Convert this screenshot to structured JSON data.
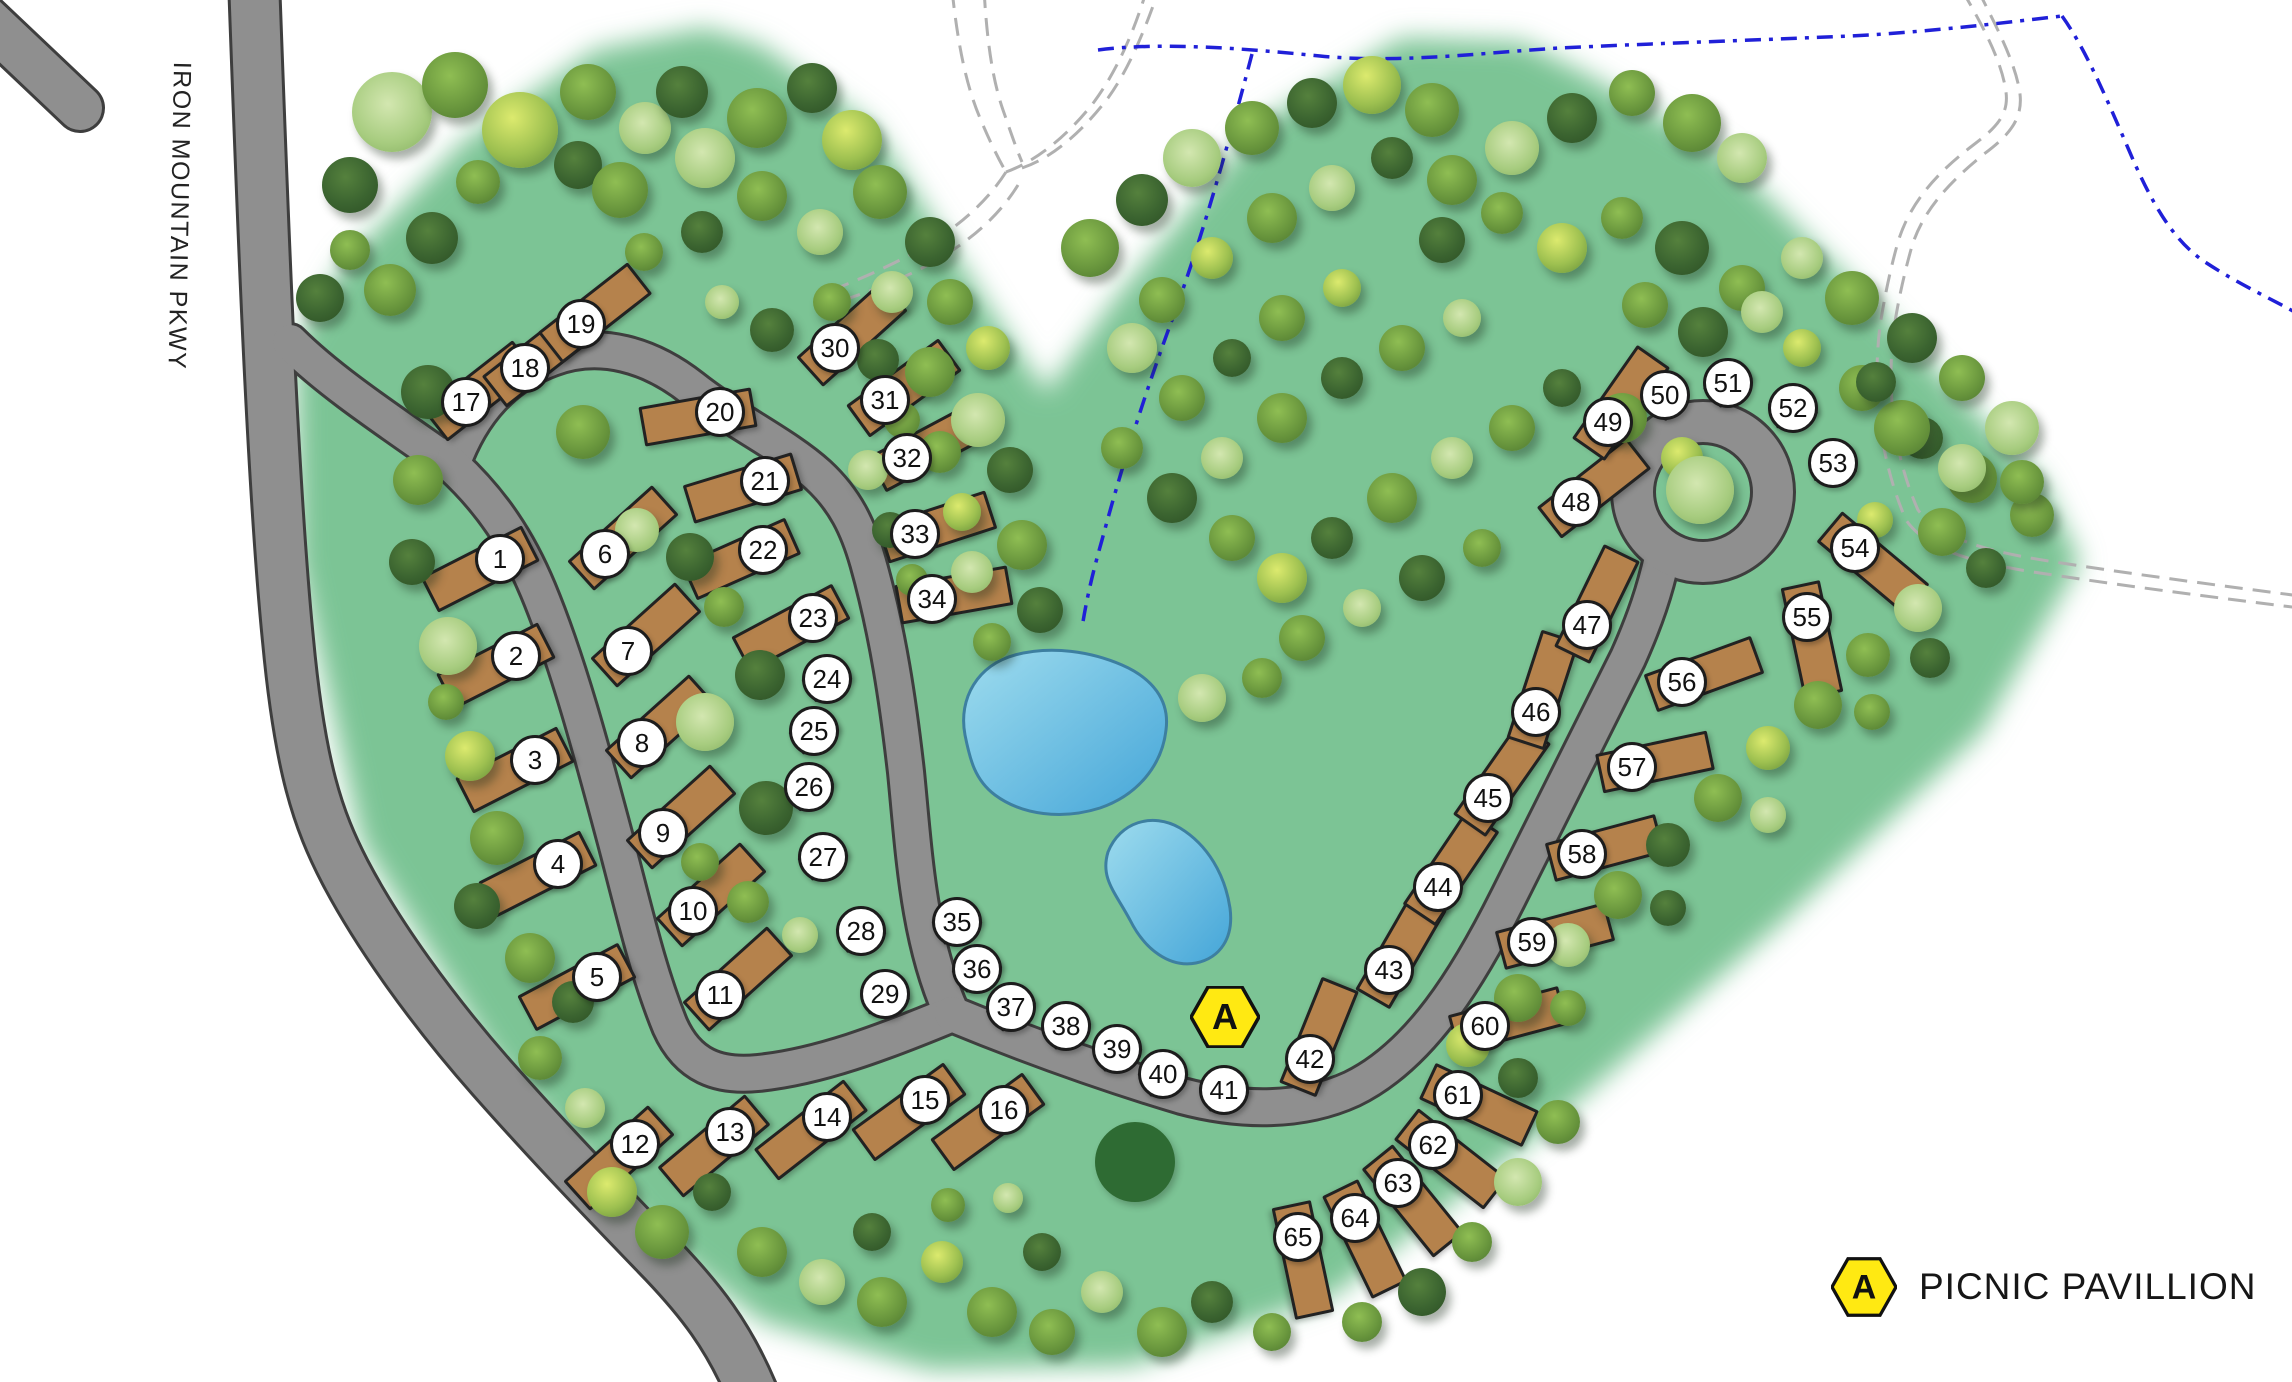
{
  "road_label": "IRON MOUNTAIN PKWY",
  "legend": {
    "marker_letter": "A",
    "label": "PICNIC PAVILLION"
  },
  "pavilion_marker": {
    "letter": "A",
    "x": 1225,
    "y": 1017
  },
  "site_dims": {
    "rv": [
      114,
      40
    ],
    "tent": [
      44,
      27
    ]
  },
  "sites_format": [
    "number",
    "x",
    "y",
    "rotation_deg",
    "type",
    "pad_offset_x",
    "pad_offset_y"
  ],
  "sites": [
    [
      1,
      500,
      559,
      -27,
      "rv",
      -20,
      10
    ],
    [
      2,
      516,
      656,
      -27,
      "rv",
      -20,
      10
    ],
    [
      3,
      535,
      760,
      -27,
      "rv",
      -20,
      10
    ],
    [
      4,
      558,
      864,
      -27,
      "rv",
      -20,
      10
    ],
    [
      5,
      597,
      977,
      -28,
      "rv",
      -20,
      10
    ],
    [
      6,
      605,
      554,
      -42,
      "rv",
      18,
      -16
    ],
    [
      7,
      628,
      651,
      -42,
      "rv",
      18,
      -16
    ],
    [
      8,
      642,
      743,
      -42,
      "rv",
      18,
      -16
    ],
    [
      9,
      663,
      833,
      -42,
      "rv",
      18,
      -16
    ],
    [
      10,
      693,
      911,
      -42,
      "rv",
      18,
      -16
    ],
    [
      11,
      720,
      995,
      -42,
      "rv",
      18,
      -16
    ],
    [
      12,
      635,
      1144,
      -42,
      "rv",
      -16,
      14
    ],
    [
      13,
      730,
      1132,
      -40,
      "rv",
      -16,
      14
    ],
    [
      14,
      827,
      1117,
      -38,
      "rv",
      -16,
      13
    ],
    [
      15,
      925,
      1100,
      -36,
      "rv",
      -16,
      12
    ],
    [
      16,
      1004,
      1110,
      -36,
      "rv",
      -16,
      12
    ],
    [
      17,
      466,
      402,
      -38,
      "rv",
      14,
      -11
    ],
    [
      18,
      525,
      368,
      -38,
      "rv",
      14,
      -11
    ],
    [
      19,
      581,
      324,
      -38,
      "rv",
      14,
      -11
    ],
    [
      20,
      720,
      412,
      -10,
      "rv",
      -22,
      5
    ],
    [
      21,
      765,
      481,
      -17,
      "rv",
      -22,
      7
    ],
    [
      22,
      763,
      550,
      -24,
      "rv",
      -22,
      9
    ],
    [
      23,
      813,
      618,
      -28,
      "rv",
      -22,
      10
    ],
    [
      24,
      827,
      679,
      -32,
      "tent",
      0,
      0
    ],
    [
      25,
      814,
      731,
      -34,
      "tent",
      0,
      0
    ],
    [
      26,
      809,
      787,
      -38,
      "tent",
      0,
      0
    ],
    [
      27,
      823,
      857,
      -34,
      "tent",
      0,
      0
    ],
    [
      28,
      861,
      931,
      -26,
      "tent",
      0,
      0
    ],
    [
      29,
      885,
      994,
      -20,
      "tent",
      0,
      0
    ],
    [
      30,
      835,
      348,
      -42,
      "rv",
      17,
      -14
    ],
    [
      31,
      885,
      400,
      -36,
      "rv",
      19,
      -12
    ],
    [
      32,
      907,
      458,
      -28,
      "rv",
      20,
      -10
    ],
    [
      33,
      915,
      534,
      -18,
      "rv",
      22,
      -7
    ],
    [
      34,
      932,
      599,
      -10,
      "rv",
      22,
      -4
    ],
    [
      35,
      957,
      922,
      -30,
      "tent",
      0,
      0
    ],
    [
      36,
      977,
      969,
      -35,
      "tent",
      0,
      0
    ],
    [
      37,
      1011,
      1007,
      -40,
      "tent",
      0,
      0
    ],
    [
      38,
      1066,
      1026,
      -35,
      "tent",
      0,
      0
    ],
    [
      39,
      1117,
      1049,
      -30,
      "tent",
      0,
      0
    ],
    [
      40,
      1163,
      1074,
      -30,
      "tent",
      0,
      0
    ],
    [
      41,
      1224,
      1090,
      -25,
      "tent",
      0,
      0
    ],
    [
      42,
      1310,
      1059,
      -68,
      "rv",
      9,
      -22
    ],
    [
      43,
      1389,
      970,
      -60,
      "rv",
      12,
      -20
    ],
    [
      44,
      1438,
      887,
      -56,
      "rv",
      13,
      -19
    ],
    [
      45,
      1488,
      798,
      -55,
      "rv",
      14,
      -19
    ],
    [
      46,
      1536,
      712,
      -72,
      "rv",
      7,
      -22
    ],
    [
      47,
      1587,
      625,
      -64,
      "rv",
      10,
      -21
    ],
    [
      48,
      1576,
      502,
      -38,
      "rv",
      18,
      -14
    ],
    [
      49,
      1608,
      422,
      -55,
      "rv",
      13,
      -19
    ],
    [
      50,
      1665,
      395,
      -62,
      "tent",
      0,
      0
    ],
    [
      51,
      1728,
      383,
      -42,
      "tent",
      0,
      0
    ],
    [
      52,
      1793,
      408,
      -20,
      "tent",
      0,
      0
    ],
    [
      53,
      1833,
      463,
      -12,
      "tent",
      0,
      0
    ],
    [
      54,
      1855,
      548,
      40,
      "rv",
      18,
      15
    ],
    [
      55,
      1807,
      617,
      78,
      "rv",
      5,
      23
    ],
    [
      56,
      1682,
      682,
      -20,
      "rv",
      22,
      -8
    ],
    [
      57,
      1632,
      767,
      -12,
      "rv",
      23,
      -5
    ],
    [
      58,
      1582,
      854,
      -15,
      "rv",
      23,
      -6
    ],
    [
      59,
      1532,
      942,
      -15,
      "rv",
      23,
      -6
    ],
    [
      60,
      1485,
      1026,
      -15,
      "rv",
      23,
      -6
    ],
    [
      61,
      1458,
      1095,
      25,
      "rv",
      21,
      10
    ],
    [
      62,
      1433,
      1145,
      38,
      "rv",
      18,
      14
    ],
    [
      63,
      1398,
      1183,
      51,
      "rv",
      15,
      18
    ],
    [
      64,
      1355,
      1218,
      64,
      "rv",
      10,
      21
    ],
    [
      65,
      1298,
      1237,
      78,
      "rv",
      5,
      23
    ]
  ],
  "trees_format": [
    "x",
    "y",
    "radius",
    "shade_variant"
  ],
  "trees": [
    [
      392,
      112,
      40,
      2
    ],
    [
      350,
      185,
      28,
      0
    ],
    [
      455,
      85,
      33,
      1
    ],
    [
      520,
      130,
      38,
      3
    ],
    [
      588,
      92,
      28,
      1
    ],
    [
      645,
      128,
      26,
      2
    ],
    [
      578,
      165,
      24,
      0
    ],
    [
      478,
      182,
      22,
      1
    ],
    [
      432,
      238,
      26,
      0
    ],
    [
      390,
      290,
      26,
      1
    ],
    [
      620,
      190,
      28,
      1
    ],
    [
      682,
      92,
      26,
      0
    ],
    [
      705,
      158,
      30,
      2
    ],
    [
      757,
      118,
      30,
      1
    ],
    [
      812,
      88,
      25,
      0
    ],
    [
      852,
      140,
      30,
      3
    ],
    [
      762,
      196,
      25,
      1
    ],
    [
      820,
      232,
      23,
      2
    ],
    [
      702,
      232,
      21,
      0
    ],
    [
      644,
      252,
      19,
      1
    ],
    [
      880,
      192,
      27,
      1
    ],
    [
      930,
      242,
      25,
      0
    ],
    [
      892,
      292,
      21,
      2
    ],
    [
      950,
      302,
      23,
      1
    ],
    [
      988,
      348,
      22,
      3
    ],
    [
      832,
      302,
      19,
      1
    ],
    [
      772,
      330,
      22,
      0
    ],
    [
      722,
      302,
      17,
      2
    ],
    [
      320,
      298,
      24,
      0
    ],
    [
      350,
      250,
      20,
      1
    ],
    [
      428,
      392,
      27,
      0
    ],
    [
      418,
      480,
      25,
      1
    ],
    [
      412,
      562,
      23,
      0
    ],
    [
      448,
      646,
      29,
      2
    ],
    [
      446,
      702,
      18,
      1
    ],
    [
      470,
      756,
      25,
      3
    ],
    [
      497,
      838,
      27,
      1
    ],
    [
      477,
      906,
      23,
      0
    ],
    [
      530,
      958,
      25,
      1
    ],
    [
      573,
      1002,
      21,
      0
    ],
    [
      540,
      1058,
      22,
      1
    ],
    [
      585,
      1108,
      20,
      2
    ],
    [
      583,
      432,
      27,
      1
    ],
    [
      637,
      530,
      22,
      2
    ],
    [
      690,
      557,
      24,
      0
    ],
    [
      724,
      607,
      20,
      1
    ],
    [
      760,
      675,
      25,
      0
    ],
    [
      705,
      722,
      29,
      2
    ],
    [
      766,
      808,
      27,
      0
    ],
    [
      700,
      862,
      19,
      1
    ],
    [
      748,
      902,
      21,
      1
    ],
    [
      800,
      935,
      18,
      2
    ],
    [
      878,
      360,
      21,
      0
    ],
    [
      930,
      372,
      25,
      1
    ],
    [
      978,
      420,
      27,
      2
    ],
    [
      940,
      452,
      21,
      1
    ],
    [
      1010,
      470,
      23,
      0
    ],
    [
      962,
      512,
      19,
      3
    ],
    [
      1022,
      545,
      25,
      1
    ],
    [
      972,
      572,
      21,
      2
    ],
    [
      1040,
      610,
      23,
      0
    ],
    [
      992,
      642,
      19,
      1
    ],
    [
      902,
      420,
      18,
      1
    ],
    [
      868,
      470,
      20,
      2
    ],
    [
      890,
      530,
      18,
      0
    ],
    [
      912,
      580,
      16,
      1
    ],
    [
      1090,
      248,
      29,
      1
    ],
    [
      1142,
      200,
      26,
      0
    ],
    [
      1192,
      158,
      29,
      2
    ],
    [
      1252,
      128,
      27,
      1
    ],
    [
      1312,
      103,
      25,
      0
    ],
    [
      1372,
      85,
      29,
      3
    ],
    [
      1432,
      110,
      27,
      1
    ],
    [
      1162,
      300,
      23,
      1
    ],
    [
      1212,
      258,
      21,
      3
    ],
    [
      1272,
      218,
      25,
      1
    ],
    [
      1332,
      188,
      23,
      2
    ],
    [
      1392,
      158,
      21,
      0
    ],
    [
      1452,
      180,
      25,
      1
    ],
    [
      1512,
      148,
      27,
      2
    ],
    [
      1572,
      118,
      25,
      0
    ],
    [
      1632,
      93,
      23,
      1
    ],
    [
      1692,
      123,
      29,
      1
    ],
    [
      1742,
      158,
      25,
      2
    ],
    [
      1442,
      240,
      23,
      0
    ],
    [
      1502,
      213,
      21,
      1
    ],
    [
      1562,
      248,
      25,
      3
    ],
    [
      1622,
      218,
      21,
      1
    ],
    [
      1682,
      248,
      27,
      0
    ],
    [
      1742,
      288,
      23,
      1
    ],
    [
      1802,
      258,
      21,
      2
    ],
    [
      1852,
      298,
      27,
      1
    ],
    [
      1912,
      338,
      25,
      0
    ],
    [
      1962,
      378,
      23,
      1
    ],
    [
      2012,
      428,
      27,
      2
    ],
    [
      1802,
      348,
      19,
      3
    ],
    [
      1862,
      388,
      23,
      1
    ],
    [
      1922,
      438,
      21,
      0
    ],
    [
      1972,
      478,
      25,
      1
    ],
    [
      2032,
      515,
      22,
      1
    ],
    [
      1132,
      348,
      25,
      2
    ],
    [
      1182,
      398,
      23,
      1
    ],
    [
      1232,
      358,
      19,
      0
    ],
    [
      1282,
      318,
      23,
      1
    ],
    [
      1342,
      288,
      19,
      3
    ],
    [
      1122,
      448,
      21,
      1
    ],
    [
      1172,
      498,
      25,
      0
    ],
    [
      1222,
      458,
      21,
      2
    ],
    [
      1282,
      418,
      25,
      1
    ],
    [
      1342,
      378,
      21,
      0
    ],
    [
      1402,
      348,
      23,
      1
    ],
    [
      1462,
      318,
      19,
      2
    ],
    [
      1232,
      538,
      23,
      1
    ],
    [
      1282,
      578,
      25,
      3
    ],
    [
      1332,
      538,
      21,
      0
    ],
    [
      1392,
      498,
      25,
      1
    ],
    [
      1452,
      458,
      21,
      2
    ],
    [
      1512,
      428,
      23,
      1
    ],
    [
      1562,
      388,
      19,
      0
    ],
    [
      1622,
      418,
      25,
      1
    ],
    [
      1682,
      458,
      21,
      3
    ],
    [
      1302,
      638,
      23,
      1
    ],
    [
      1362,
      608,
      19,
      2
    ],
    [
      1422,
      578,
      23,
      0
    ],
    [
      1482,
      548,
      19,
      1
    ],
    [
      1202,
      698,
      24,
      2
    ],
    [
      1262,
      678,
      20,
      1
    ],
    [
      1700,
      490,
      34,
      2
    ],
    [
      1645,
      305,
      23,
      1
    ],
    [
      1703,
      332,
      25,
      0
    ],
    [
      1762,
      312,
      21,
      2
    ],
    [
      1902,
      428,
      28,
      1
    ],
    [
      1962,
      468,
      24,
      2
    ],
    [
      1876,
      382,
      20,
      0
    ],
    [
      2022,
      482,
      22,
      1
    ],
    [
      1942,
      532,
      24,
      1
    ],
    [
      1986,
      568,
      20,
      0
    ],
    [
      1875,
      520,
      18,
      3
    ],
    [
      1918,
      608,
      24,
      2
    ],
    [
      1868,
      655,
      22,
      1
    ],
    [
      1930,
      658,
      20,
      0
    ],
    [
      1818,
      705,
      24,
      1
    ],
    [
      1768,
      748,
      22,
      3
    ],
    [
      1872,
      712,
      18,
      1
    ],
    [
      1718,
      798,
      24,
      1
    ],
    [
      1668,
      845,
      22,
      0
    ],
    [
      1768,
      815,
      18,
      2
    ],
    [
      1618,
      895,
      24,
      1
    ],
    [
      1568,
      945,
      22,
      2
    ],
    [
      1668,
      908,
      18,
      0
    ],
    [
      1518,
      998,
      24,
      1
    ],
    [
      1468,
      1045,
      22,
      3
    ],
    [
      1568,
      1008,
      18,
      1
    ],
    [
      1518,
      1078,
      20,
      0
    ],
    [
      1558,
      1122,
      22,
      1
    ],
    [
      1518,
      1182,
      24,
      2
    ],
    [
      1472,
      1242,
      20,
      1
    ],
    [
      1422,
      1292,
      24,
      0
    ],
    [
      1362,
      1322,
      20,
      1
    ],
    [
      612,
      1192,
      25,
      3
    ],
    [
      662,
      1232,
      27,
      1
    ],
    [
      712,
      1192,
      19,
      0
    ],
    [
      762,
      1252,
      25,
      1
    ],
    [
      822,
      1282,
      23,
      2
    ],
    [
      872,
      1232,
      19,
      0
    ],
    [
      882,
      1302,
      25,
      1
    ],
    [
      942,
      1262,
      21,
      3
    ],
    [
      992,
      1312,
      25,
      1
    ],
    [
      1042,
      1252,
      19,
      0
    ],
    [
      1052,
      1332,
      23,
      1
    ],
    [
      1102,
      1292,
      21,
      2
    ],
    [
      1135,
      1162,
      40,
      4
    ],
    [
      1162,
      1332,
      25,
      1
    ],
    [
      1212,
      1302,
      21,
      0
    ],
    [
      1272,
      1332,
      19,
      1
    ],
    [
      948,
      1205,
      17,
      1
    ],
    [
      1008,
      1198,
      15,
      2
    ]
  ],
  "colors": {
    "green_area": "#7cc495",
    "road_fill": "#8f8f8f",
    "road_casing": "#3e3e3e",
    "rv_pad": "#b5824c",
    "tent_pad": "#d8af3c",
    "pond": "#66b8dd",
    "stream": "#2020d8",
    "trail": "#b0b0b0",
    "marker_yellow": "#ffe912"
  }
}
